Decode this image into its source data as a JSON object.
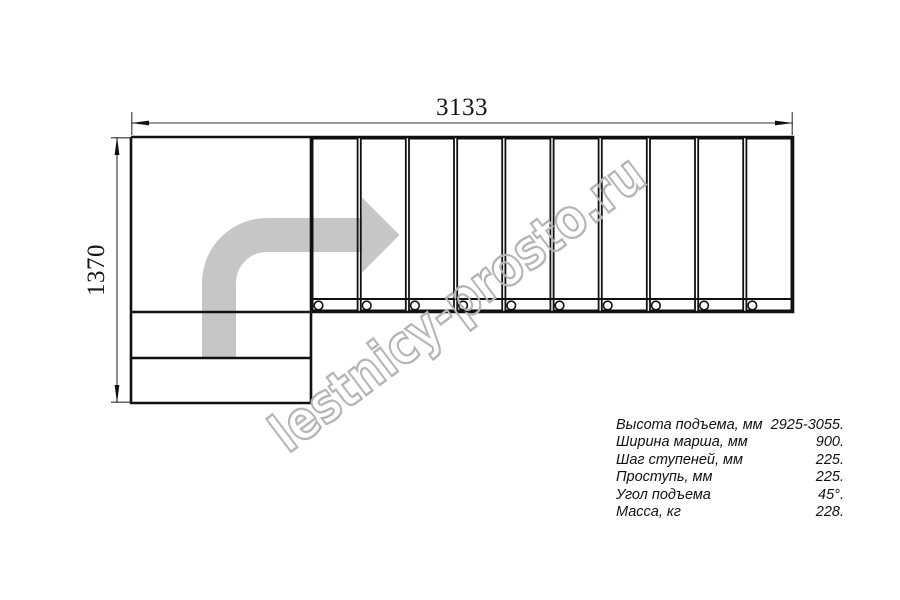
{
  "drawing": {
    "type": "staircase-plan-view",
    "dimensions": {
      "total_width_mm": "3133",
      "total_depth_mm": "1370"
    },
    "stair": {
      "straight_treads": 10,
      "mounting_holes": 10,
      "lower_steps": 2,
      "landing": 1
    },
    "watermark": "lestnicy-prosto.ru",
    "colors": {
      "object_line": "#111111",
      "dimension_line": "#333333",
      "direction_arrow": "#c6c6c6",
      "watermark": "#b5b5b5"
    }
  },
  "specs": {
    "rows": [
      {
        "label": "Высота подъема, мм",
        "value": "2925-3055."
      },
      {
        "label": "Ширина марша, мм",
        "value": "900."
      },
      {
        "label": "Шаг ступеней, мм",
        "value": "225."
      },
      {
        "label": "Проступь, мм",
        "value": "225."
      },
      {
        "label": "Угол подъема",
        "value": "45°."
      },
      {
        "label": "Масса, кг",
        "value": "228."
      }
    ]
  }
}
